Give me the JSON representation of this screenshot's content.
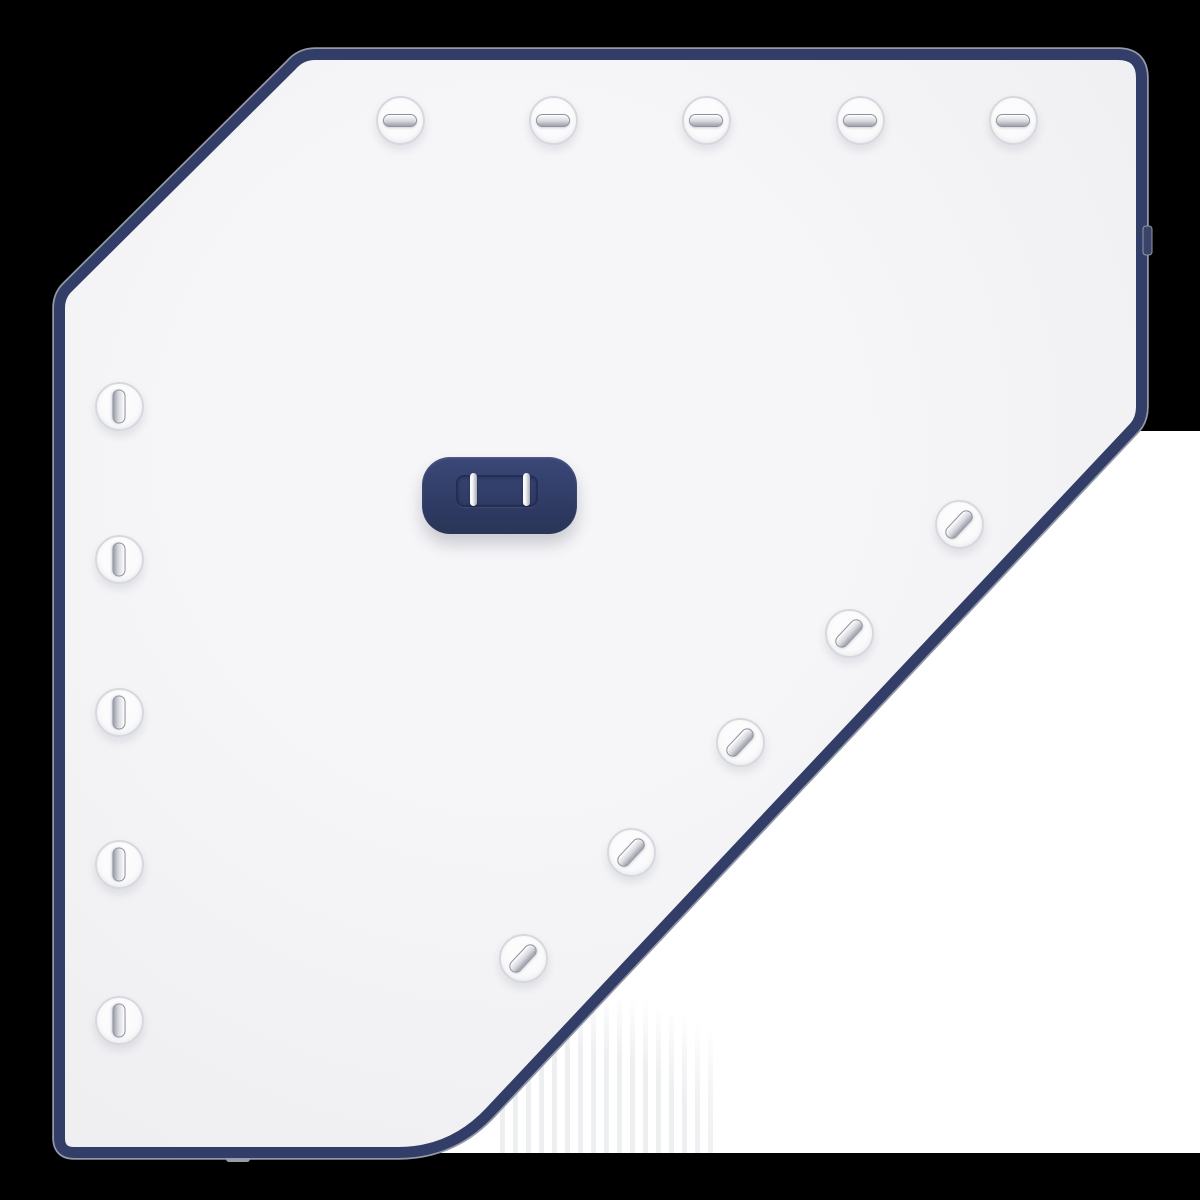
{
  "scene": {
    "kind": "3d-product-render",
    "object": "pentagonal cover panel with navy trim, snap fasteners and a strap buckle",
    "visible_text": ""
  },
  "colors": {
    "bg": "#000000",
    "photo-bg": "#ffffff",
    "panel-face": "#f6f6f8",
    "panel-face-edge": "#ededf0",
    "panel-border": "#323e67",
    "rim": "#9298a6",
    "tab": "#3a4468",
    "nub": "#989ca8",
    "buckle-top": "#3b4878",
    "buckle-bot": "#2d3960",
    "slot-outline": "#222c52",
    "pin-hi": "#f7f7fa",
    "pin-lo": "#a9abb8",
    "disc": "#fafafb",
    "disc-ring": "#d7d8de",
    "bar-hi": "#f5f5f7",
    "bar-mid": "#d7d8dd",
    "bar-lo": "#a7a9b4",
    "bar-edge": "#8f919c",
    "stripe": "rgba(150,155,170,0.30)"
  },
  "panel": {
    "shape": "hexagon with clipped top-left and bottom-right corners",
    "edge_tab_count": 1
  },
  "fasteners": {
    "count": 15,
    "groups": [
      {
        "edge": "top",
        "count": 5,
        "bar_orientation": "horizontal"
      },
      {
        "edge": "left",
        "count": 5,
        "bar_orientation": "vertical"
      },
      {
        "edge": "diagonal",
        "count": 5,
        "bar_orientation": "tilted"
      }
    ]
  },
  "buckle": {
    "pin_count": 2,
    "shape": "rounded rectangle with recessed slot"
  }
}
